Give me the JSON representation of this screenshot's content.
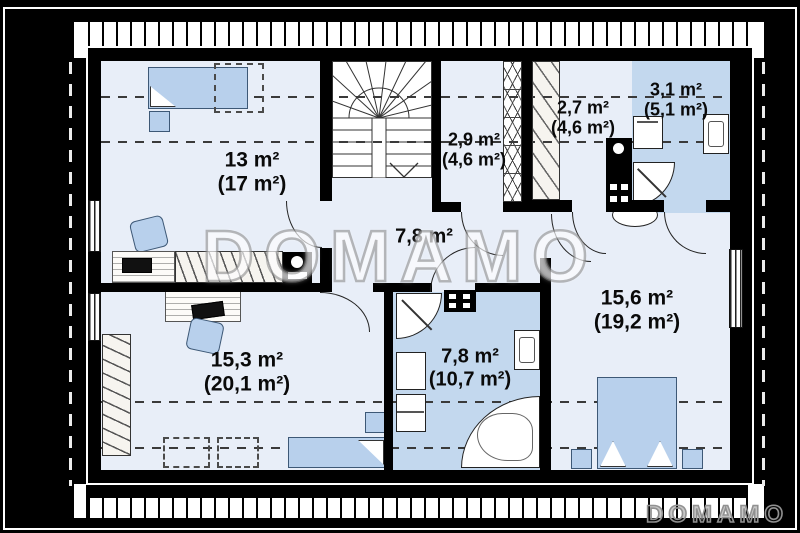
{
  "plan": {
    "watermark": "DOMAMO",
    "brand": "DOMAMO",
    "rooms": [
      {
        "id": "bedroom-top-left",
        "area": "13 m²",
        "total_area": "(17 m²)"
      },
      {
        "id": "landing",
        "area": "2,9 m²",
        "total_area": "(4,6 m²)"
      },
      {
        "id": "wardrobe-room",
        "area": "2,7 m²",
        "total_area": "(4,6 m²)"
      },
      {
        "id": "bathroom-small",
        "area": "3,1 m²",
        "total_area": "(5,1 m²)"
      },
      {
        "id": "hallway",
        "area": "7,8 m²",
        "total_area": ""
      },
      {
        "id": "bedroom-right",
        "area": "15,6 m²",
        "total_area": "(19,2 m²)"
      },
      {
        "id": "bedroom-bottom-left",
        "area": "15,3 m²",
        "total_area": "(20,1 m²)"
      },
      {
        "id": "bathroom-main",
        "area": "7,8 m²",
        "total_area": "(10,7 m²)"
      }
    ],
    "colors": {
      "wall": "#000000",
      "room_fill": "#e8eef8",
      "bath_fill": "#c3d8ee",
      "furn_fill": "#b8d0ec",
      "watermark_gray": "#8f8f8f"
    }
  }
}
